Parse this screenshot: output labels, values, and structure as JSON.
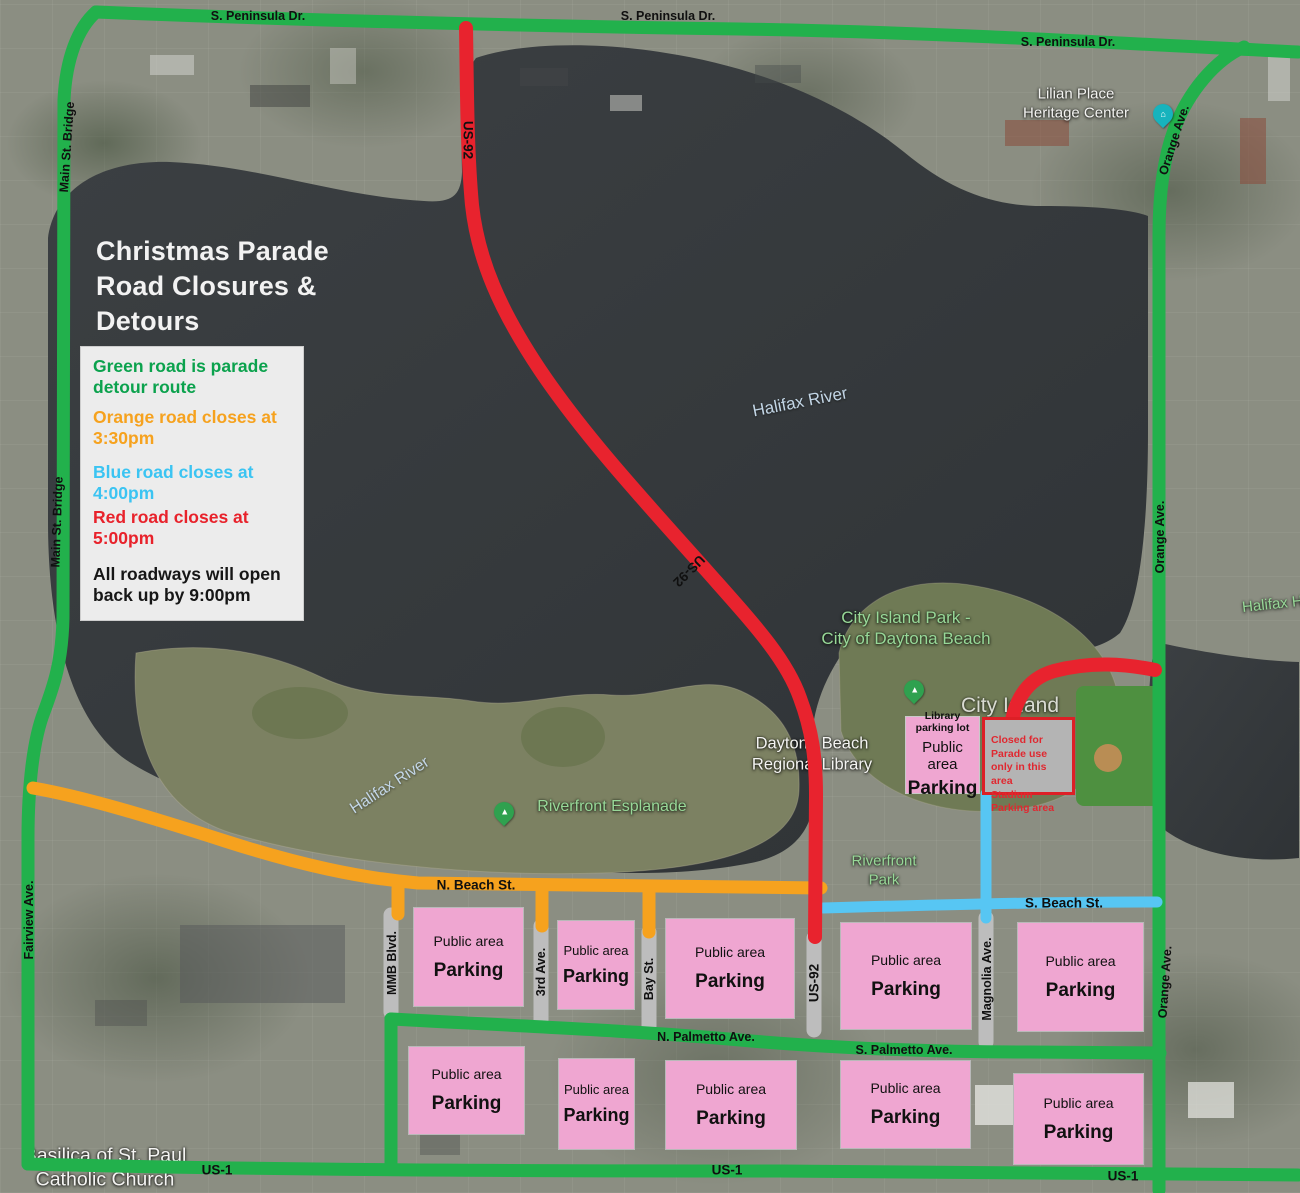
{
  "title": "Christmas Parade Road Closures & Detours",
  "legend": {
    "items": [
      {
        "text": "Green road is parade detour route",
        "color": "#0ba24d"
      },
      {
        "text": "Orange road closes at 3:30pm",
        "color": "#f6a21e"
      },
      {
        "text": "Blue road closes at 4:00pm",
        "color": "#3bc4f2"
      },
      {
        "text": "Red road closes at 5:00pm",
        "color": "#e8222b"
      }
    ],
    "footer": "All roadways will open back up by 9:00pm"
  },
  "roads": {
    "detour_green": "#22b14c",
    "closes_330_orange": "#f6a21e",
    "closes_400_blue": "#57c6f3",
    "closes_500_red": "#e8232e",
    "street_gray": "#bdbdbd"
  },
  "street_labels": {
    "s_peninsula_dr_1": "S. Peninsula Dr.",
    "s_peninsula_dr_2": "S. Peninsula Dr.",
    "s_peninsula_dr_3": "S. Peninsula Dr.",
    "main_st_bridge_1": "Main St. Bridge",
    "main_st_bridge_2": "Main St. Bridge",
    "us_92_north": "US-92",
    "us_92_mid": "US-92",
    "us_92_south": "US-92",
    "orange_ave_1": "Orange Ave.",
    "orange_ave_2": "Orange Ave.",
    "orange_ave_3": "Orange Ave.",
    "fairview_ave": "Fairview Ave.",
    "n_beach_st": "N. Beach St.",
    "s_beach_st": "S. Beach St.",
    "n_palmetto_ave": "N. Palmetto Ave.",
    "s_palmetto_ave": "S. Palmetto Ave.",
    "us_1_west": "US-1",
    "us_1_center": "US-1",
    "us_1_east": "US-1",
    "mmb_blvd": "MMB Blvd.",
    "third_ave": "3rd Ave.",
    "bay_st": "Bay St.",
    "magnolia_ave": "Magnolia Ave."
  },
  "place_labels": {
    "lilian_place": {
      "line1": "Lilian Place",
      "line2": "Heritage Center"
    },
    "halifax_river_main": "Halifax River",
    "halifax_river_west": "Halifax River",
    "halifax_harbor_east": "Halifax Harbor",
    "city_island_park": {
      "line1": "City Island Park -",
      "line2": "City of Daytona Beach"
    },
    "city_island": "City Island",
    "regional_library": {
      "line1": "Daytona Beach",
      "line2": "Regional Library"
    },
    "riverfront_esplanade": "Riverfront Esplanade",
    "riverfront_park": {
      "line1": "Riverfront",
      "line2": "Park"
    },
    "basilica": {
      "line1": "Basilica of St. Paul",
      "line2": "Catholic Church"
    }
  },
  "parking": {
    "box_color": "#efa6d1",
    "public_boxes": [
      {
        "line1": "Public area",
        "line2": "Parking"
      },
      {
        "line1": "Public area",
        "line2": "Parking"
      },
      {
        "line1": "Public area",
        "line2": "Parking"
      },
      {
        "line1": "Public area",
        "line2": "Parking"
      },
      {
        "line1": "Public area",
        "line2": "Parking"
      },
      {
        "line1": "Public area",
        "line2": "Parking"
      },
      {
        "line1": "Public area",
        "line2": "Parking"
      },
      {
        "line1": "Public area",
        "line2": "Parking"
      },
      {
        "line1": "Public area",
        "line2": "Parking"
      },
      {
        "line1": "Public area",
        "line2": "Parking"
      }
    ],
    "library_box": {
      "line1": "Library parking lot",
      "line2": "Public area",
      "line3": "Parking"
    },
    "stadium_box": {
      "text": "Closed for Parade use\nonly in this area\nStadium Parking area",
      "text_color": "#e02830",
      "border_color": "#dd1f26"
    }
  },
  "icons": {
    "park_pin_color": "#2fa14f",
    "park_pin_glyph": "▲",
    "heritage_pin_color": "#17b3bd",
    "heritage_pin_glyph": "⌂"
  }
}
